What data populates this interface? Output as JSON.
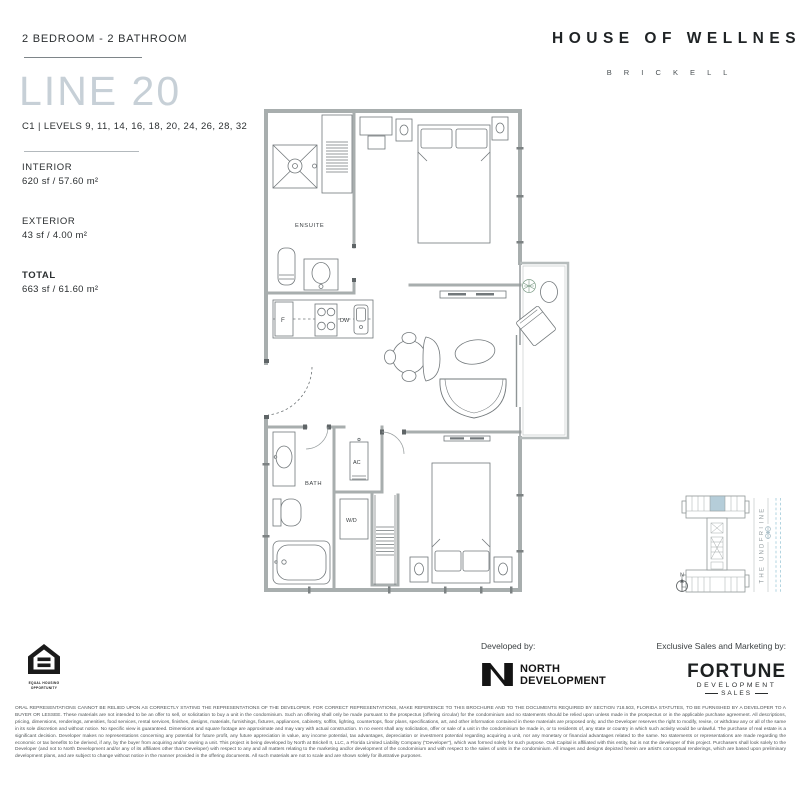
{
  "header": {
    "unit_type": "2 BEDROOM - 2 BATHROOM",
    "line_title": "LINE 20",
    "levels": "C1  |  LEVELS 9, 11, 14, 16, 18, 20, 24, 26, 28, 32",
    "brand_title": "HOUSE OF WELLNESS",
    "brand_subtitle": "B R I C K E L L"
  },
  "stats": {
    "interior_label": "INTERIOR",
    "interior_value": "620 sf  /  57.60 m²",
    "exterior_label": "EXTERIOR",
    "exterior_value": "43 sf  /  4.00 m²",
    "total_label": "TOTAL",
    "total_value": "663 sf  /  61.60 m²"
  },
  "floorplan": {
    "labels": {
      "ensuite": "ENSUITE",
      "fridge": "F",
      "dishwasher": "DW",
      "bath": "BATH",
      "ac": "AC",
      "washer_dryer": "W/D"
    }
  },
  "keyplan": {
    "underline_label": "THE UNDERLINE",
    "north_label": "N",
    "highlight_color": "#b5cdd9"
  },
  "footer": {
    "equal_housing_line1": "EQUAL HOUSING",
    "equal_housing_line2": "OPPORTUNITY",
    "developed_by": "Developed by:",
    "developer_line1": "NORTH",
    "developer_line2": "DEVELOPMENT",
    "sales_by": "Exclusive Sales and Marketing by:",
    "sales_brand_line1": "FORTUNE",
    "sales_brand_line2": "DEVELOPMENT",
    "sales_brand_line3": "SALES"
  },
  "disclaimer": "ORAL REPRESENTATIONS CANNOT BE RELIED UPON AS CORRECTLY STATING THE REPRESENTATIONS OF THE DEVELOPER. FOR CORRECT REPRESENTATIONS, MAKE REFERENCE TO THIS BROCHURE AND TO THE DOCUMENTS REQUIRED BY SECTION 718.503, FLORIDA STATUTES, TO BE FURNISHED BY A DEVELOPER TO A BUYER OR LESSEE. These materials are not intended to be an offer to sell, or solicitation to buy a unit in the condominium. Such an offering shall only be made pursuant to the prospectus (offering circular) for the condominium and no statements should be relied upon unless made in the prospectus or in the applicable purchase agreement. All descriptions, pricing, dimensions, renderings, amenities, food services, rental services, finishes, designs, materials, furnishings, fixtures, appliances, cabinetry, soffits, lighting, countertops, floor plans, specifications, art, and other information contained in these materials are proposed only, and the Developer reserves the right to modify, revise, or withdraw any or all of the same in its sole discretion and without notice. No specific view is guaranteed. Dimensions and square footage are approximate and may vary with actual construction. In no event shall any solicitation, offer or sale of a unit in the condominium be made in, or to residents of, any state or country in which such activity would be unlawful. The purchase of real estate is a significant decision. Developer makes no representations concerning any potential for future profit, any future appreciation in value, any income potential, tax advantages, depreciation or investment potential regarding acquiring a unit, nor any monetary or financial advantages related to the same. No statements or representations are made regarding the economic or tax benefits to be derived, if any, by the buyer from acquiring and/or owning a unit. This project is being developed by North at Brickell II, LLC, a Florida Limited Liability Company (\"Developer\"), which was formed solely for such purpose. Oak Capital is affiliated with this entity, but is not the developer of this project. Purchasers shall look solely to the Developer (and not to North Development and/or any of its affiliates other than Developer) with respect to any and all matters relating to the marketing and/or development of the condominium and with respect to the sales of units in the condominium. All images and designs depicted herein are artist's conceptual renderings, which are based upon preliminary development plans, and are subject to change without notice in the manner provided in the offering documents. All such materials are not to scale and are shown solely for illustrative purposes."
}
